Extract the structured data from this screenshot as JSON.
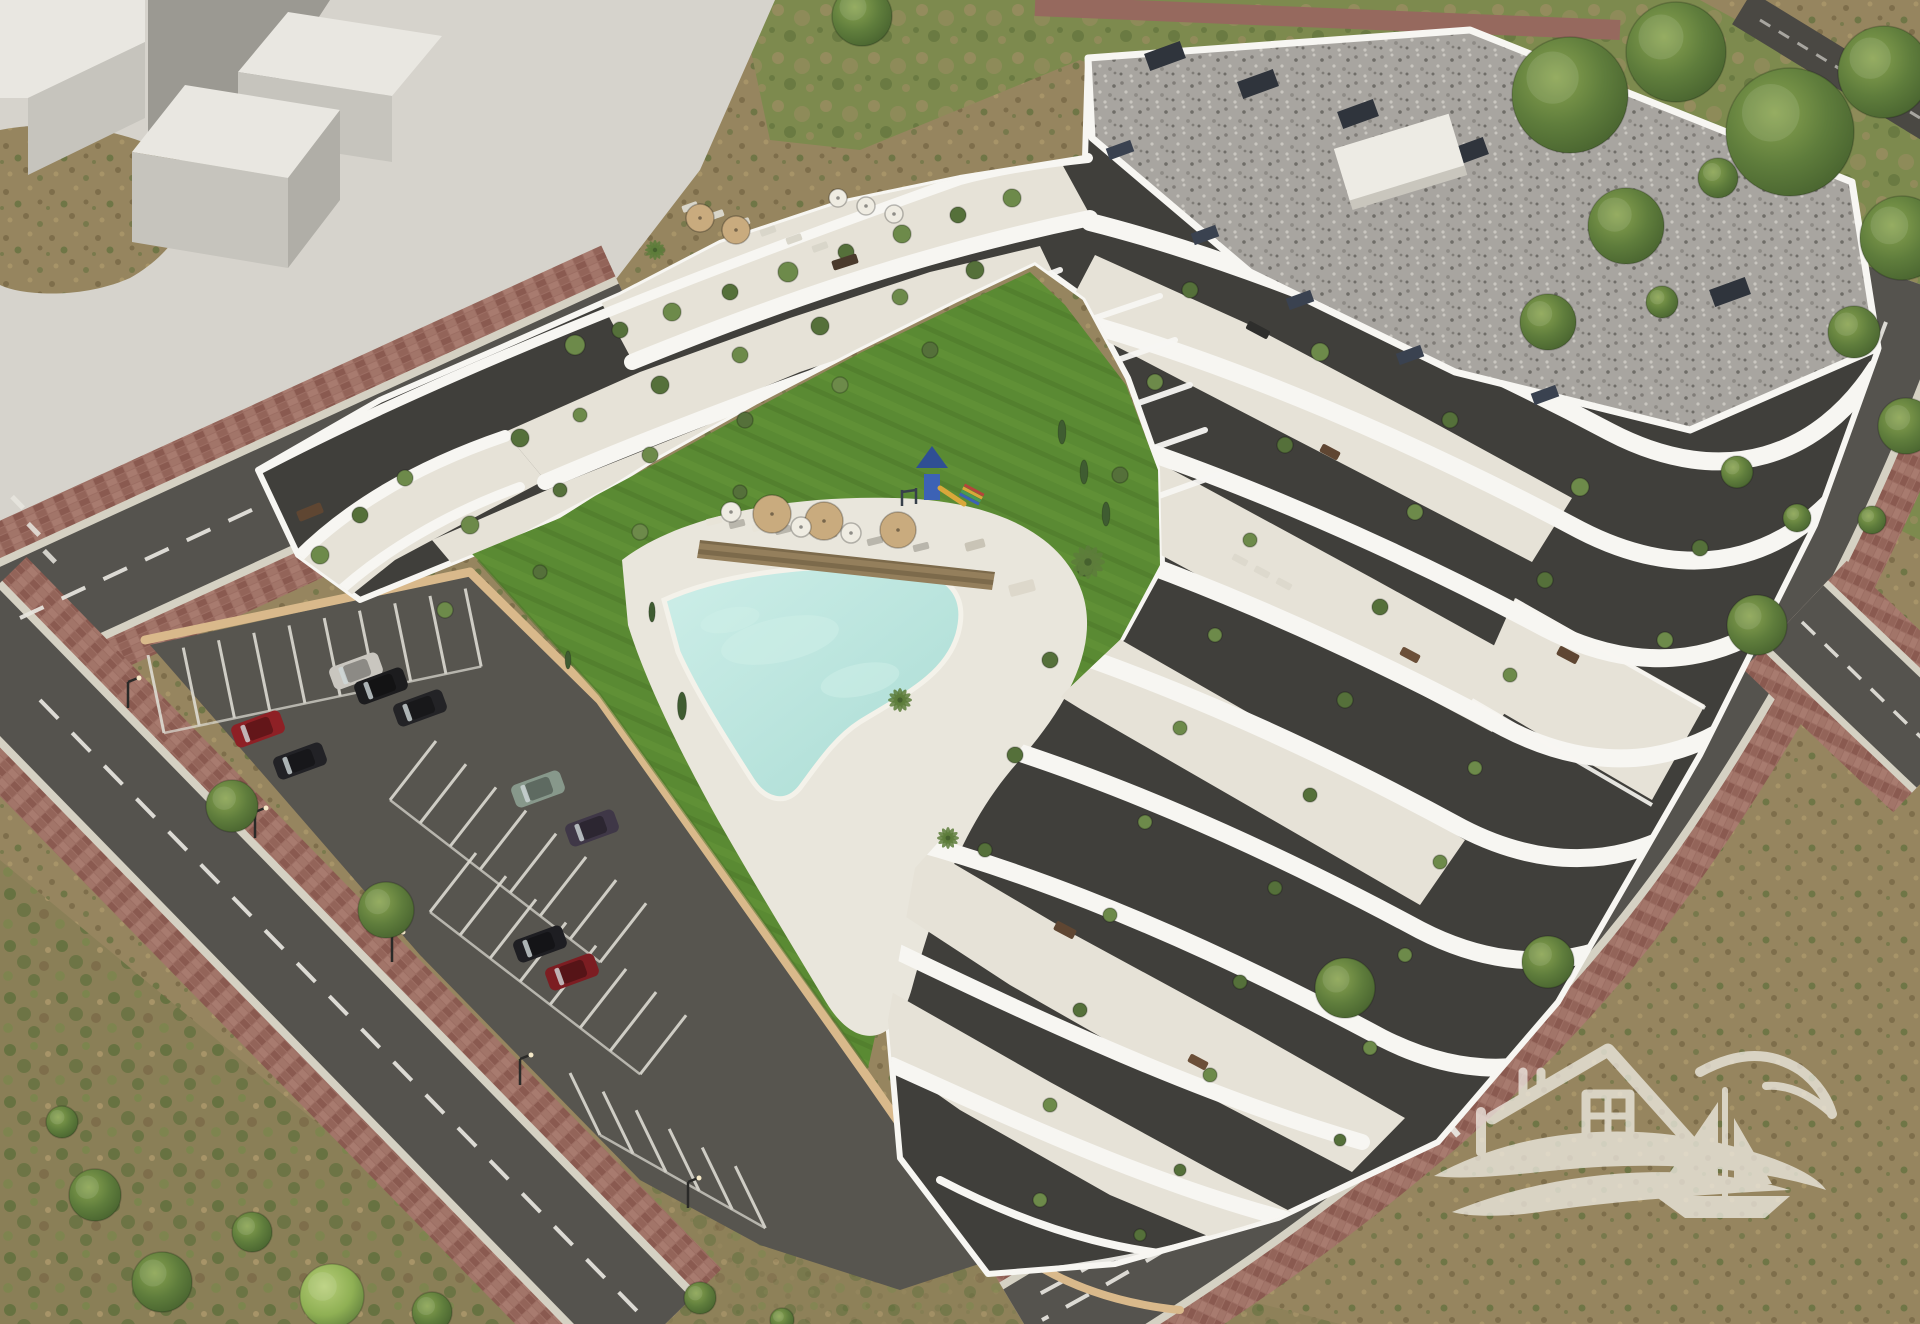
{
  "meta": {
    "kind": "architectural-aerial-render",
    "subject": "white terraced apartment complex with courtyard pool, lawn, playground, parking lot and perimeter streets on scrubland",
    "canvas": {
      "width": 1920,
      "height": 1324
    }
  },
  "palette": {
    "dirt": "#96855f",
    "dirtDark": "#7e6e4b",
    "dirtLight": "#a79468",
    "scrubGreen": "#5e6f3c",
    "scrubGreenLight": "#76874a",
    "grassVerge": "#7d8a4e",
    "grassDry": "#9a8c60",
    "lawn": "#5a8a33",
    "lawnLight": "#649539",
    "lawnDark": "#4c7429",
    "poolWater": "#aadcd4",
    "poolWaterLight": "#cdeee8",
    "poolDeck": "#e9e6dc",
    "roadAsphalt": "#55534e",
    "roadLine": "#e8e6df",
    "curb": "#d5d1c3",
    "sidewalkBrick": "#9c6e63",
    "brickDark": "#8a5a50",
    "brickLight": "#a87b6f",
    "parkingAsphalt": "#57554f",
    "plaza": "#d6d3cc",
    "massingTop": "#e9e7e1",
    "massingSide": "#c6c4bd",
    "massingShadow": "#908e87",
    "buildingWhite": "#f7f6f2",
    "terraceCream": "#e6e2d7",
    "facadeDark": "#403f3b",
    "glassDark": "#2b2b29",
    "roofGravel": "#a8a5a0",
    "planterSlate": "#3a4250",
    "wallTan": "#d9b98b",
    "treeGreen": "#5f7d3c",
    "treeGreenDark": "#46612e",
    "treeGreenLight": "#8aa451",
    "umbrellaTan": "#c9ab7e",
    "umbrellaWhite": "#efece2",
    "woodBrown": "#8a7450",
    "playBlue": "#3c62b5",
    "playBlueDark": "#2f4f94",
    "playYellow": "#d9a73a",
    "playRed": "#b5453a",
    "playGreen": "#4a9a55",
    "watermark": "#f4f1ea"
  },
  "scene": {
    "legend": {
      "cars": "[x, y, rotationDeg, bodyColor]",
      "trees": "[x, y, radius, tone(d=dark,l=light)]",
      "plants": "[x, y, radius]  terrace shrubs on balconies",
      "cypresses": "[x, y, height]",
      "palms": "[x, y, radius]",
      "umbrellas": "[x, y, radius, kind(t=tan,w=white)]",
      "loungers": "[x, y, rotationDeg, color]",
      "furniture": "[x, y, w, h, rotationDeg, color]",
      "stallRows": "parking stall line rows {x,y,dx,dy,n,step,lx,ly}",
      "streetlights": "[x, y]"
    },
    "cars": [
      [
        356,
        671,
        -20,
        "#c9c6bf"
      ],
      [
        381,
        686,
        -20,
        "#1c1c1e"
      ],
      [
        420,
        708,
        -20,
        "#232326"
      ],
      [
        258,
        729,
        -20,
        "#8e2025"
      ],
      [
        300,
        761,
        -20,
        "#222226"
      ],
      [
        538,
        789,
        -20,
        "#87988b"
      ],
      [
        592,
        828,
        -20,
        "#3f3747"
      ],
      [
        540,
        944,
        -20,
        "#1e1e22"
      ],
      [
        572,
        972,
        -20,
        "#7c1d22"
      ]
    ],
    "trees": [
      [
        1570,
        95,
        58,
        "d"
      ],
      [
        1676,
        52,
        50,
        "d"
      ],
      [
        1790,
        132,
        64,
        "d"
      ],
      [
        1884,
        72,
        46,
        "d"
      ],
      [
        1902,
        238,
        42,
        "d"
      ],
      [
        1626,
        226,
        38,
        "d"
      ],
      [
        1548,
        322,
        28,
        "d"
      ],
      [
        1854,
        332,
        26,
        "d"
      ],
      [
        1906,
        426,
        28,
        "d"
      ],
      [
        1757,
        625,
        30,
        "d"
      ],
      [
        1548,
        962,
        26,
        "d"
      ],
      [
        1345,
        988,
        30,
        "d"
      ],
      [
        232,
        806,
        26,
        "d"
      ],
      [
        386,
        910,
        28,
        "d"
      ],
      [
        95,
        1195,
        26,
        "d"
      ],
      [
        162,
        1282,
        30,
        "d"
      ],
      [
        332,
        1296,
        32,
        "l"
      ],
      [
        252,
        1232,
        20,
        "d"
      ],
      [
        62,
        1122,
        16,
        "d"
      ],
      [
        432,
        1312,
        20,
        "d"
      ],
      [
        700,
        1298,
        16,
        "d"
      ],
      [
        782,
        1320,
        12,
        "d"
      ],
      [
        862,
        16,
        30,
        "d"
      ],
      [
        1737,
        472,
        16,
        "d"
      ],
      [
        1797,
        518,
        14,
        "d"
      ],
      [
        1718,
        178,
        20,
        "d"
      ],
      [
        1662,
        302,
        16,
        "d"
      ],
      [
        1872,
        520,
        14,
        "d"
      ]
    ],
    "plants": [
      [
        575,
        345,
        10
      ],
      [
        620,
        330,
        8
      ],
      [
        672,
        312,
        9
      ],
      [
        730,
        292,
        8
      ],
      [
        788,
        272,
        10
      ],
      [
        846,
        252,
        8
      ],
      [
        902,
        234,
        9
      ],
      [
        958,
        215,
        8
      ],
      [
        1012,
        198,
        9
      ],
      [
        520,
        438,
        9
      ],
      [
        580,
        415,
        7
      ],
      [
        660,
        385,
        9
      ],
      [
        740,
        355,
        8
      ],
      [
        820,
        326,
        9
      ],
      [
        900,
        297,
        8
      ],
      [
        975,
        270,
        9
      ],
      [
        470,
        525,
        9
      ],
      [
        560,
        490,
        7
      ],
      [
        650,
        455,
        8
      ],
      [
        745,
        420,
        8
      ],
      [
        840,
        385,
        8
      ],
      [
        930,
        350,
        8
      ],
      [
        445,
        610,
        8
      ],
      [
        540,
        572,
        7
      ],
      [
        640,
        532,
        8
      ],
      [
        740,
        492,
        7
      ],
      [
        320,
        555,
        9
      ],
      [
        360,
        515,
        8
      ],
      [
        405,
        478,
        8
      ],
      [
        1190,
        290,
        8
      ],
      [
        1320,
        352,
        9
      ],
      [
        1450,
        420,
        8
      ],
      [
        1580,
        487,
        9
      ],
      [
        1700,
        548,
        8
      ],
      [
        1155,
        382,
        8
      ],
      [
        1285,
        445,
        8
      ],
      [
        1415,
        512,
        8
      ],
      [
        1545,
        580,
        8
      ],
      [
        1665,
        640,
        8
      ],
      [
        1120,
        475,
        8
      ],
      [
        1250,
        540,
        7
      ],
      [
        1380,
        607,
        8
      ],
      [
        1510,
        675,
        7
      ],
      [
        1085,
        568,
        8
      ],
      [
        1215,
        635,
        7
      ],
      [
        1345,
        700,
        8
      ],
      [
        1475,
        768,
        7
      ],
      [
        1050,
        660,
        8
      ],
      [
        1180,
        728,
        7
      ],
      [
        1310,
        795,
        7
      ],
      [
        1440,
        862,
        7
      ],
      [
        1015,
        755,
        8
      ],
      [
        1145,
        822,
        7
      ],
      [
        1275,
        888,
        7
      ],
      [
        1405,
        955,
        7
      ],
      [
        985,
        850,
        7
      ],
      [
        1110,
        915,
        7
      ],
      [
        1240,
        982,
        7
      ],
      [
        1370,
        1048,
        7
      ],
      [
        1080,
        1010,
        7
      ],
      [
        1210,
        1075,
        7
      ],
      [
        1340,
        1140,
        6
      ],
      [
        1050,
        1105,
        7
      ],
      [
        1180,
        1170,
        6
      ],
      [
        1040,
        1200,
        7
      ],
      [
        1140,
        1235,
        6
      ]
    ],
    "cypresses": [
      [
        682,
        706,
        14
      ],
      [
        1062,
        432,
        12
      ],
      [
        1084,
        472,
        12
      ],
      [
        1106,
        514,
        12
      ],
      [
        652,
        612,
        10
      ],
      [
        568,
        660,
        9
      ]
    ],
    "palms": [
      [
        1088,
        562,
        17
      ],
      [
        900,
        700,
        12
      ],
      [
        948,
        838,
        11
      ],
      [
        655,
        250,
        10
      ]
    ],
    "umbrellas": [
      [
        772,
        514,
        19,
        "t"
      ],
      [
        824,
        521,
        19,
        "t"
      ],
      [
        898,
        530,
        18,
        "t"
      ],
      [
        700,
        218,
        14,
        "t"
      ],
      [
        736,
        230,
        14,
        "t"
      ],
      [
        731,
        512,
        10,
        "w"
      ],
      [
        801,
        527,
        10,
        "w"
      ],
      [
        851,
        533,
        10,
        "w"
      ],
      [
        838,
        198,
        9,
        "w"
      ],
      [
        866,
        206,
        9,
        "w"
      ],
      [
        894,
        214,
        9,
        "w"
      ]
    ],
    "loungers": [
      [
        714,
        521,
        -14,
        "#e8e4d8"
      ],
      [
        737,
        524,
        -14,
        "#b9b6ac"
      ],
      [
        760,
        527,
        -14,
        "#e8e4d8"
      ],
      [
        783,
        530,
        -14,
        "#b9b6ac"
      ],
      [
        806,
        533,
        -14,
        "#e8e4d8"
      ],
      [
        829,
        535,
        -14,
        "#b9b6ac"
      ],
      [
        852,
        538,
        -14,
        "#e8e4d8"
      ],
      [
        875,
        541,
        -14,
        "#b9b6ac"
      ],
      [
        898,
        544,
        -14,
        "#e8e4d8"
      ],
      [
        921,
        547,
        -14,
        "#b9b6ac"
      ],
      [
        690,
        207,
        -20,
        "#d9d6ca"
      ],
      [
        716,
        215,
        -20,
        "#d9d6ca"
      ],
      [
        742,
        223,
        -20,
        "#d9d6ca"
      ],
      [
        768,
        231,
        -20,
        "#d9d6ca"
      ],
      [
        794,
        239,
        -20,
        "#d9d6ca"
      ],
      [
        820,
        247,
        -20,
        "#d9d6ca"
      ],
      [
        1240,
        560,
        28,
        "#ddd9cd"
      ],
      [
        1262,
        572,
        28,
        "#ddd9cd"
      ],
      [
        1284,
        584,
        28,
        "#ddd9cd"
      ]
    ],
    "furniture": [
      [
        310,
        512,
        26,
        11,
        -22,
        "#5f4632"
      ],
      [
        845,
        262,
        26,
        10,
        -18,
        "#4a3a2c"
      ],
      [
        1258,
        330,
        24,
        9,
        28,
        "#2e2e2c"
      ],
      [
        1330,
        452,
        20,
        9,
        28,
        "#5f4632"
      ],
      [
        1410,
        655,
        20,
        9,
        28,
        "#6b4f38"
      ],
      [
        1065,
        930,
        22,
        10,
        28,
        "#5f4632"
      ],
      [
        1198,
        1062,
        20,
        9,
        28,
        "#6b4f38"
      ],
      [
        1568,
        655,
        22,
        10,
        28,
        "#5f4632"
      ],
      [
        1022,
        588,
        26,
        12,
        -15,
        "#ddd8cb"
      ],
      [
        975,
        545,
        20,
        9,
        -15,
        "#c9c4b6"
      ]
    ],
    "stallRows": [
      {
        "x": 164,
        "y": 733,
        "dx": 0.979,
        "dy": -0.205,
        "n": 10,
        "step": 36,
        "lx": -16,
        "ly": -78
      },
      {
        "x": 390,
        "y": 800,
        "dx": 0.79,
        "dy": 0.61,
        "n": 8,
        "step": 38,
        "lx": 46,
        "ly": -59
      },
      {
        "x": 430,
        "y": 912,
        "dx": 0.79,
        "dy": 0.61,
        "n": 8,
        "step": 38,
        "lx": 46,
        "ly": -59
      },
      {
        "x": 600,
        "y": 1135,
        "dx": 0.87,
        "dy": 0.49,
        "n": 6,
        "step": 38,
        "lx": -30,
        "ly": -62
      }
    ],
    "streetlights": [
      [
        255,
        838
      ],
      [
        392,
        962
      ],
      [
        520,
        1085
      ],
      [
        128,
        708
      ],
      [
        688,
        1208
      ],
      [
        1690,
        562
      ],
      [
        1590,
        872
      ]
    ],
    "playground": {
      "x": 932,
      "y": 480
    },
    "poolRipples": [
      [
        780,
        640,
        60,
        22
      ],
      [
        860,
        680,
        40,
        16
      ],
      [
        730,
        620,
        30,
        12
      ]
    ]
  },
  "watermark": {
    "motifs": [
      "house-outline",
      "four-pane-window",
      "chimney",
      "double-wave",
      "sailboat",
      "seagull"
    ],
    "opacity": 0.72
  }
}
